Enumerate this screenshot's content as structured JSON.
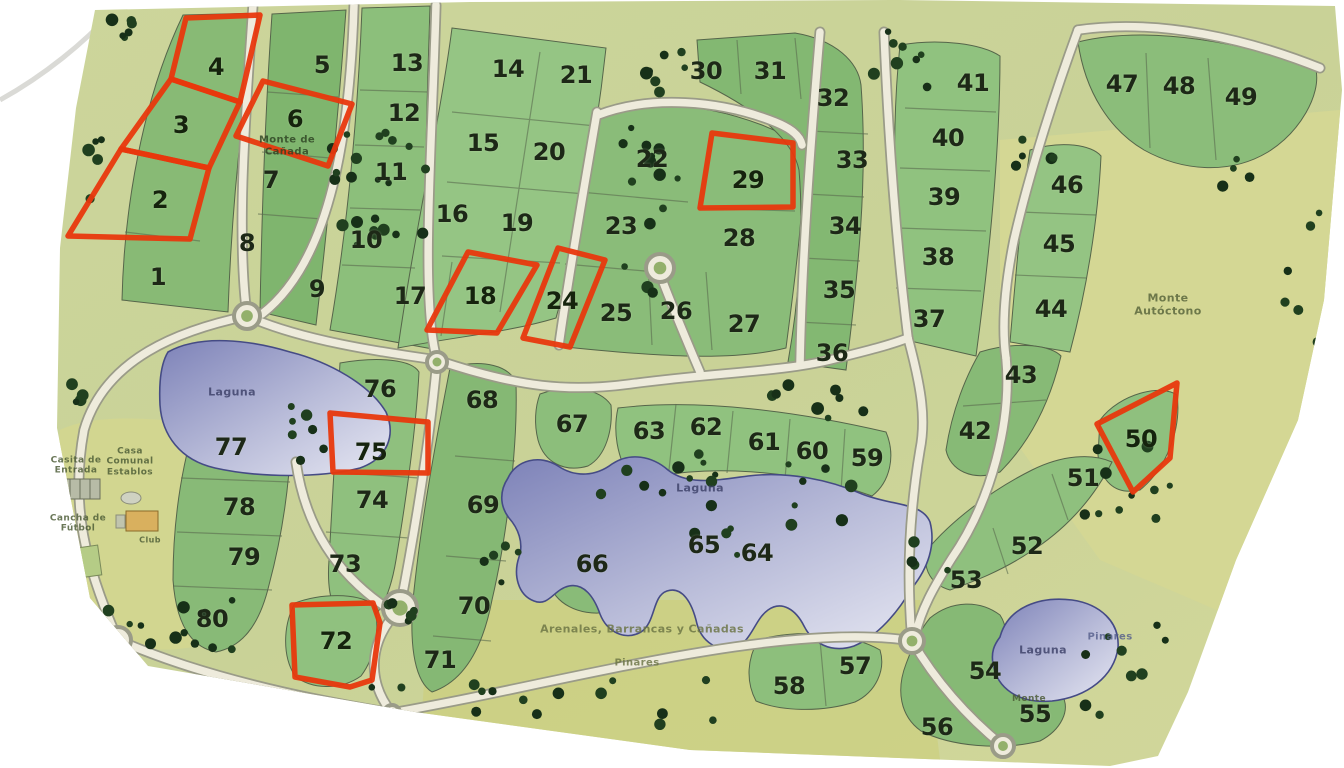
{
  "map": {
    "type": "masterplan-lot-map",
    "highlight_color": "#e8380d",
    "highlighted_lots": [
      2,
      3,
      4,
      6,
      18,
      24,
      29,
      50,
      72,
      75
    ],
    "lots": [
      {
        "n": 1,
        "x": 158,
        "y": 277
      },
      {
        "n": 2,
        "x": 160,
        "y": 200
      },
      {
        "n": 3,
        "x": 181,
        "y": 125
      },
      {
        "n": 4,
        "x": 216,
        "y": 67
      },
      {
        "n": 5,
        "x": 322,
        "y": 65
      },
      {
        "n": 6,
        "x": 295,
        "y": 119
      },
      {
        "n": 7,
        "x": 271,
        "y": 180
      },
      {
        "n": 8,
        "x": 247,
        "y": 243
      },
      {
        "n": 9,
        "x": 317,
        "y": 289
      },
      {
        "n": 10,
        "x": 366,
        "y": 240
      },
      {
        "n": 11,
        "x": 391,
        "y": 172
      },
      {
        "n": 12,
        "x": 404,
        "y": 113
      },
      {
        "n": 13,
        "x": 407,
        "y": 63
      },
      {
        "n": 14,
        "x": 508,
        "y": 69
      },
      {
        "n": 15,
        "x": 483,
        "y": 143
      },
      {
        "n": 16,
        "x": 452,
        "y": 214
      },
      {
        "n": 17,
        "x": 410,
        "y": 296
      },
      {
        "n": 18,
        "x": 480,
        "y": 296
      },
      {
        "n": 19,
        "x": 517,
        "y": 223
      },
      {
        "n": 20,
        "x": 549,
        "y": 152
      },
      {
        "n": 21,
        "x": 576,
        "y": 75
      },
      {
        "n": 22,
        "x": 652,
        "y": 159
      },
      {
        "n": 23,
        "x": 621,
        "y": 226
      },
      {
        "n": 24,
        "x": 562,
        "y": 301
      },
      {
        "n": 25,
        "x": 616,
        "y": 313
      },
      {
        "n": 26,
        "x": 676,
        "y": 311
      },
      {
        "n": 27,
        "x": 744,
        "y": 324
      },
      {
        "n": 28,
        "x": 739,
        "y": 238
      },
      {
        "n": 29,
        "x": 748,
        "y": 180
      },
      {
        "n": 30,
        "x": 706,
        "y": 71
      },
      {
        "n": 31,
        "x": 770,
        "y": 71
      },
      {
        "n": 32,
        "x": 833,
        "y": 98
      },
      {
        "n": 33,
        "x": 852,
        "y": 160
      },
      {
        "n": 34,
        "x": 845,
        "y": 226
      },
      {
        "n": 35,
        "x": 839,
        "y": 290
      },
      {
        "n": 36,
        "x": 832,
        "y": 353
      },
      {
        "n": 37,
        "x": 929,
        "y": 319
      },
      {
        "n": 38,
        "x": 938,
        "y": 257
      },
      {
        "n": 39,
        "x": 944,
        "y": 197
      },
      {
        "n": 40,
        "x": 948,
        "y": 138
      },
      {
        "n": 41,
        "x": 973,
        "y": 83
      },
      {
        "n": 42,
        "x": 975,
        "y": 431
      },
      {
        "n": 43,
        "x": 1021,
        "y": 375
      },
      {
        "n": 44,
        "x": 1051,
        "y": 309
      },
      {
        "n": 45,
        "x": 1059,
        "y": 244
      },
      {
        "n": 46,
        "x": 1067,
        "y": 185
      },
      {
        "n": 47,
        "x": 1122,
        "y": 84
      },
      {
        "n": 48,
        "x": 1179,
        "y": 86
      },
      {
        "n": 49,
        "x": 1241,
        "y": 97
      },
      {
        "n": 50,
        "x": 1141,
        "y": 439
      },
      {
        "n": 51,
        "x": 1083,
        "y": 478
      },
      {
        "n": 52,
        "x": 1027,
        "y": 546
      },
      {
        "n": 53,
        "x": 966,
        "y": 580
      },
      {
        "n": 54,
        "x": 985,
        "y": 671
      },
      {
        "n": 55,
        "x": 1035,
        "y": 714
      },
      {
        "n": 56,
        "x": 937,
        "y": 727
      },
      {
        "n": 57,
        "x": 855,
        "y": 666
      },
      {
        "n": 58,
        "x": 789,
        "y": 686
      },
      {
        "n": 59,
        "x": 867,
        "y": 458
      },
      {
        "n": 60,
        "x": 812,
        "y": 451
      },
      {
        "n": 61,
        "x": 764,
        "y": 442
      },
      {
        "n": 62,
        "x": 706,
        "y": 427
      },
      {
        "n": 63,
        "x": 649,
        "y": 431
      },
      {
        "n": 64,
        "x": 757,
        "y": 553
      },
      {
        "n": 65,
        "x": 704,
        "y": 545
      },
      {
        "n": 66,
        "x": 592,
        "y": 564
      },
      {
        "n": 67,
        "x": 572,
        "y": 424
      },
      {
        "n": 68,
        "x": 482,
        "y": 400
      },
      {
        "n": 69,
        "x": 483,
        "y": 505
      },
      {
        "n": 70,
        "x": 474,
        "y": 606
      },
      {
        "n": 71,
        "x": 440,
        "y": 660
      },
      {
        "n": 72,
        "x": 336,
        "y": 641
      },
      {
        "n": 73,
        "x": 345,
        "y": 564
      },
      {
        "n": 74,
        "x": 372,
        "y": 500
      },
      {
        "n": 75,
        "x": 371,
        "y": 452
      },
      {
        "n": 76,
        "x": 380,
        "y": 389
      },
      {
        "n": 77,
        "x": 231,
        "y": 447
      },
      {
        "n": 78,
        "x": 239,
        "y": 507
      },
      {
        "n": 79,
        "x": 244,
        "y": 557
      },
      {
        "n": 80,
        "x": 212,
        "y": 619
      }
    ],
    "labels": [
      {
        "id": "laguna-west",
        "text": "Laguna",
        "x": 232,
        "y": 393,
        "size": 11,
        "color": "#3c4068"
      },
      {
        "id": "laguna-central",
        "text": "Laguna",
        "x": 700,
        "y": 489,
        "size": 11,
        "color": "#3c4068"
      },
      {
        "id": "laguna-southeast",
        "text": "Laguna",
        "x": 1043,
        "y": 651,
        "size": 11,
        "color": "#3c4068"
      },
      {
        "id": "monte-autoctono",
        "text": "Monte\nAutóctono",
        "x": 1168,
        "y": 305,
        "size": 11,
        "color": "#57643a"
      },
      {
        "id": "monte-de-canada",
        "text": "Monte de\nCañada",
        "x": 287,
        "y": 146,
        "size": 10,
        "color": "#2e4323"
      },
      {
        "id": "arenales",
        "text": "Arenales, Barrancas y Cañadas",
        "x": 642,
        "y": 630,
        "size": 11,
        "color": "#6b7444"
      },
      {
        "id": "pinares-south",
        "text": "Pinares",
        "x": 637,
        "y": 663,
        "size": 10,
        "color": "#6b7444"
      },
      {
        "id": "pinares-east",
        "text": "Pinares",
        "x": 1110,
        "y": 637,
        "size": 10,
        "color": "#565f8c"
      },
      {
        "id": "monte-south",
        "text": "Monte",
        "x": 1029,
        "y": 699,
        "size": 9,
        "color": "#4a5a34"
      },
      {
        "id": "casita-de-entrada",
        "text": "Casita de\nEntrada",
        "x": 76,
        "y": 466,
        "size": 9,
        "color": "#4a5a34"
      },
      {
        "id": "casa-comunal",
        "text": "Casa\nComunal\nEstablos",
        "x": 130,
        "y": 462,
        "size": 9,
        "color": "#4a5a34"
      },
      {
        "id": "club",
        "text": "Club",
        "x": 150,
        "y": 540,
        "size": 8,
        "color": "#4a5a34"
      },
      {
        "id": "cancha-de-futbol",
        "text": "Cancha de\nFútbol",
        "x": 78,
        "y": 524,
        "size": 9,
        "color": "#4a5a34"
      }
    ]
  }
}
